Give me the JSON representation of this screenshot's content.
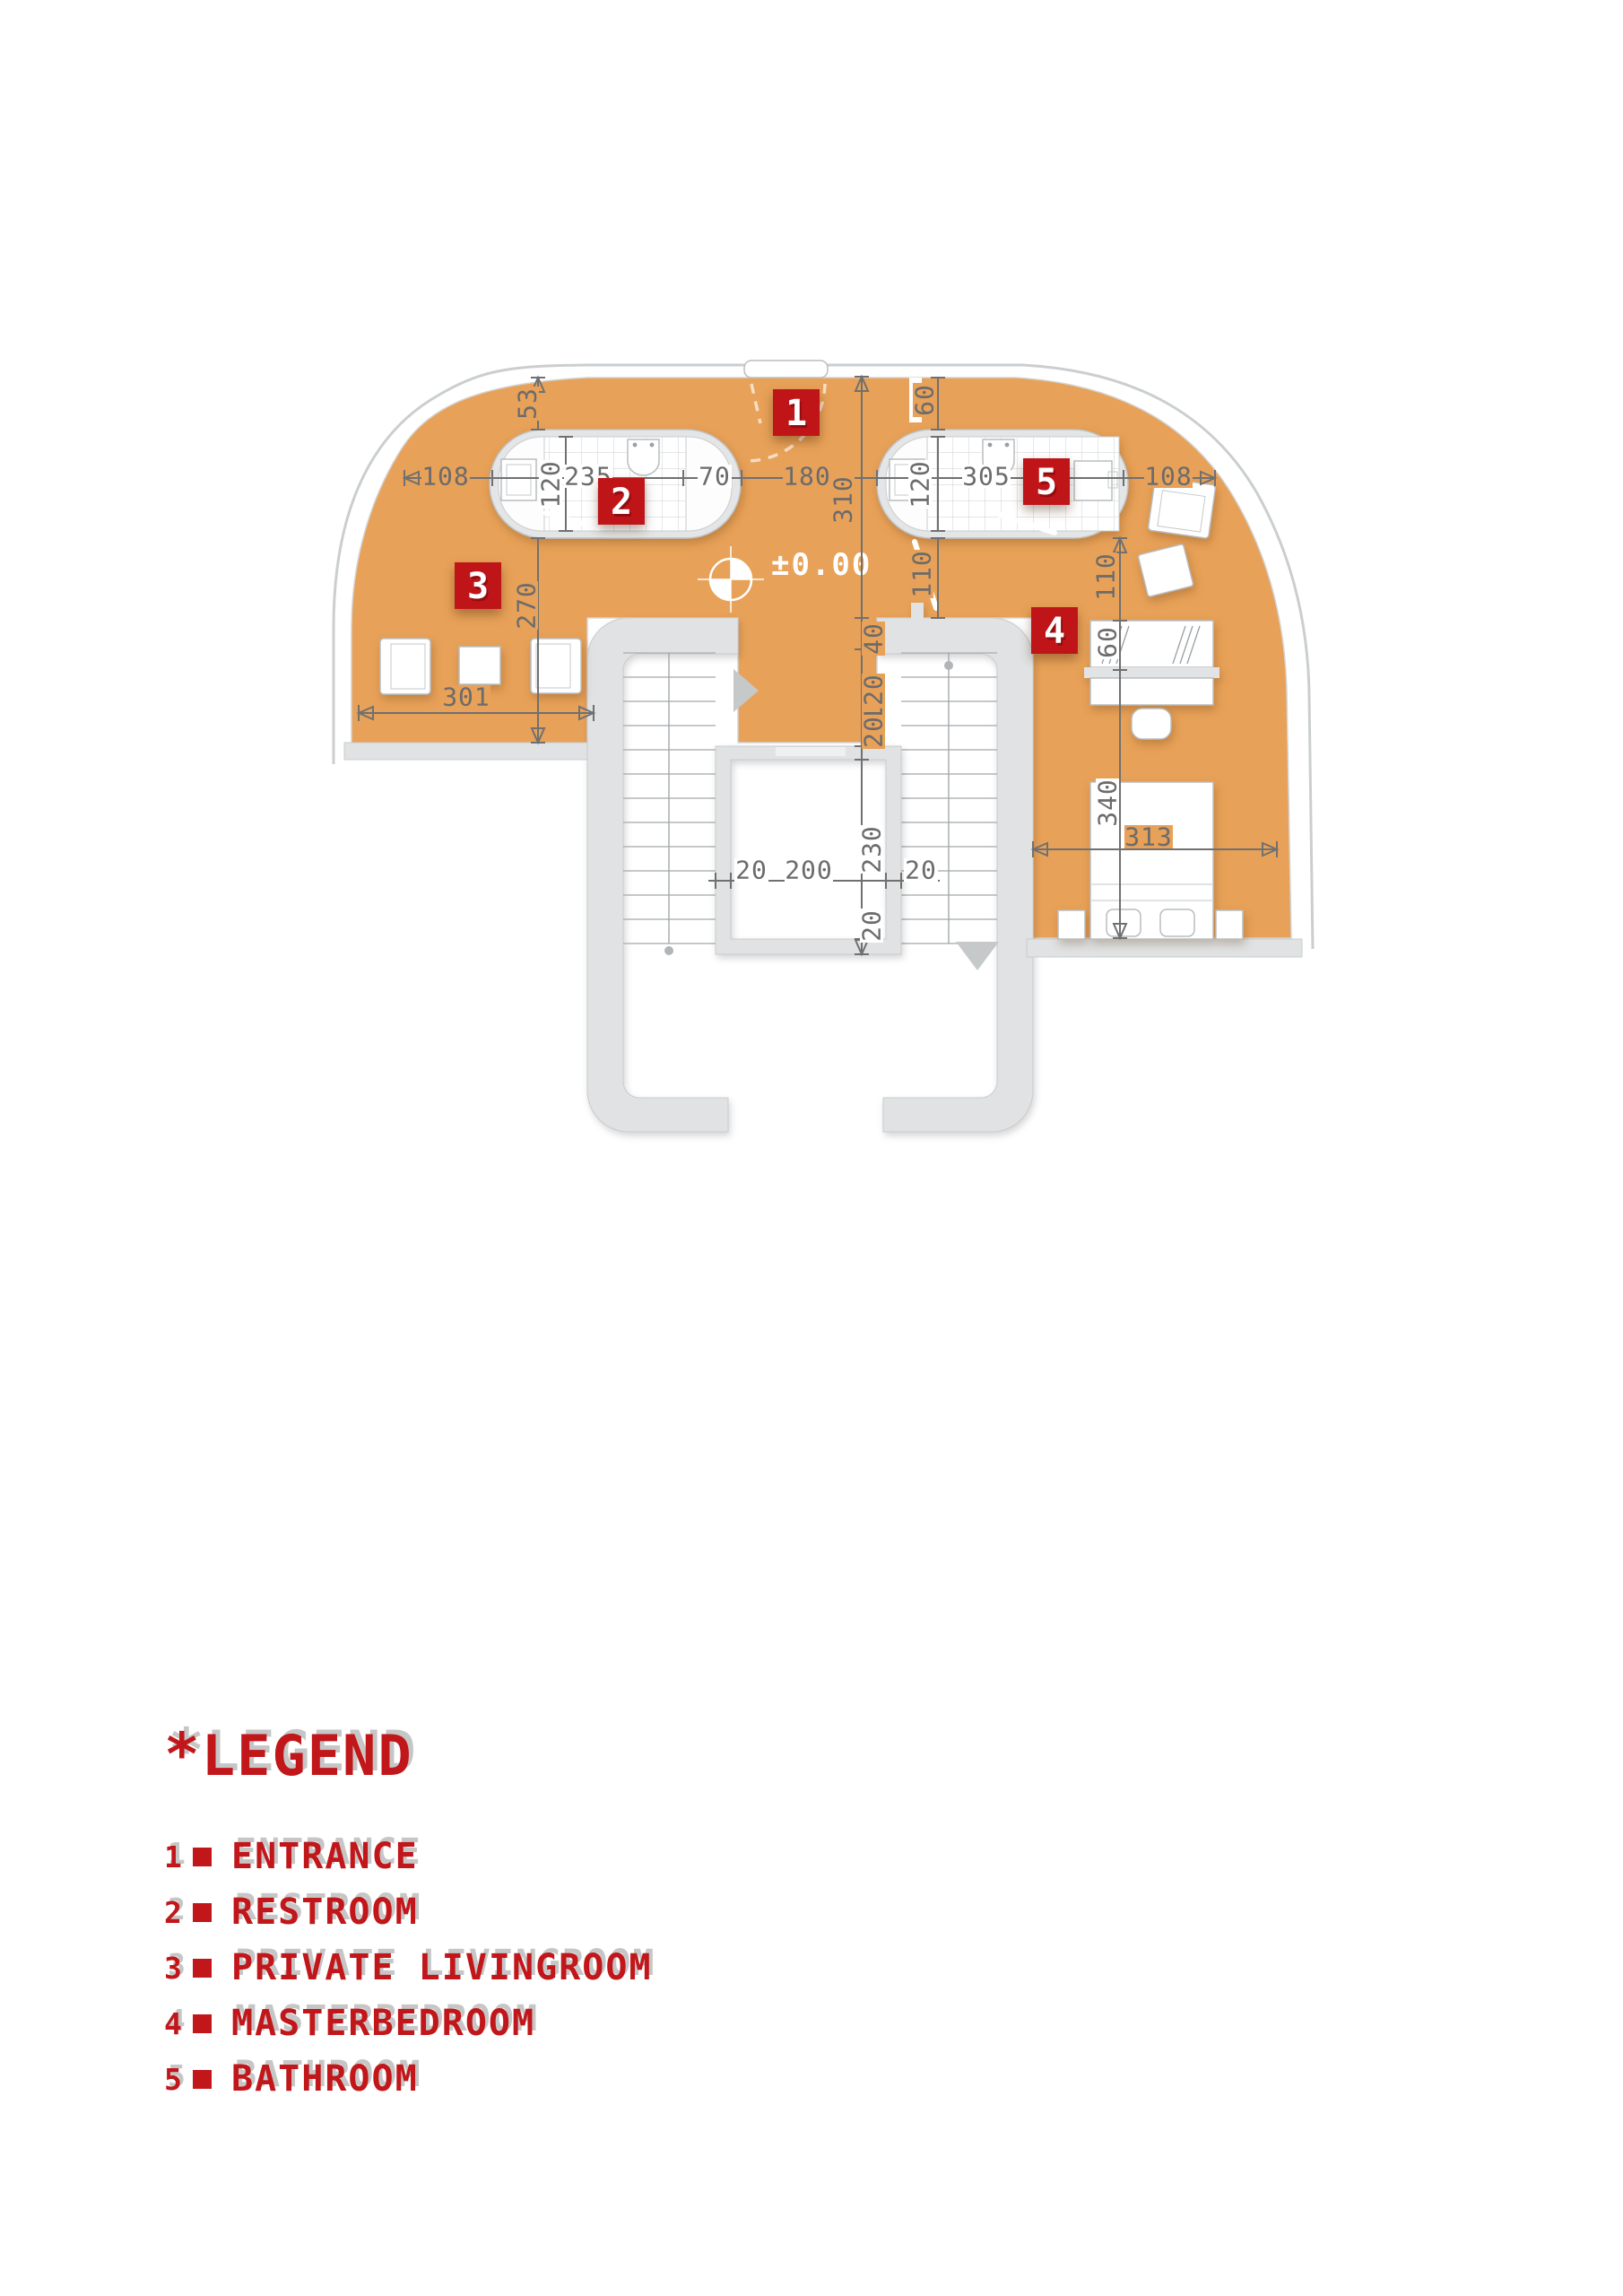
{
  "colors": {
    "floor_orange": "#e8a158",
    "marker_red": "#c01518",
    "legend_red": "#c1161a",
    "wall_gray": "#e0e2e3",
    "dim_gray": "#6b6b6b",
    "page_white": "#ffffff"
  },
  "plan": {
    "level_label": "±0.00",
    "markers": {
      "m1": "1",
      "m2": "2",
      "m3": "3",
      "m4": "4",
      "m5": "5"
    },
    "dims": {
      "v53": "53",
      "h108_left": "108",
      "v120_left": "120",
      "h235": "235",
      "h70": "70",
      "h180": "180",
      "v310": "310",
      "v60_top": "60",
      "v120_right": "120",
      "h305": "305",
      "h108_right": "108",
      "v270": "270",
      "h301": "301",
      "v110_left": "110",
      "v110_right": "110",
      "v40": "40",
      "v120_mid": "120",
      "v20_mid": "20",
      "v230": "230",
      "v20_bottom": "20",
      "h20_left": "20",
      "h200": "200",
      "h20_right": "20",
      "v60_desk": "60",
      "v340": "340",
      "h313": "313"
    }
  },
  "legend": {
    "title_prefix": "*",
    "title": "LEGEND",
    "items": [
      {
        "num": "1",
        "label": "ENTRANCE"
      },
      {
        "num": "2",
        "label": "RESTROOM"
      },
      {
        "num": "3",
        "label": "PRIVATE LIVINGROOM"
      },
      {
        "num": "4",
        "label": "MASTERBEDROOM"
      },
      {
        "num": "5",
        "label": "BATHROOM"
      }
    ]
  }
}
